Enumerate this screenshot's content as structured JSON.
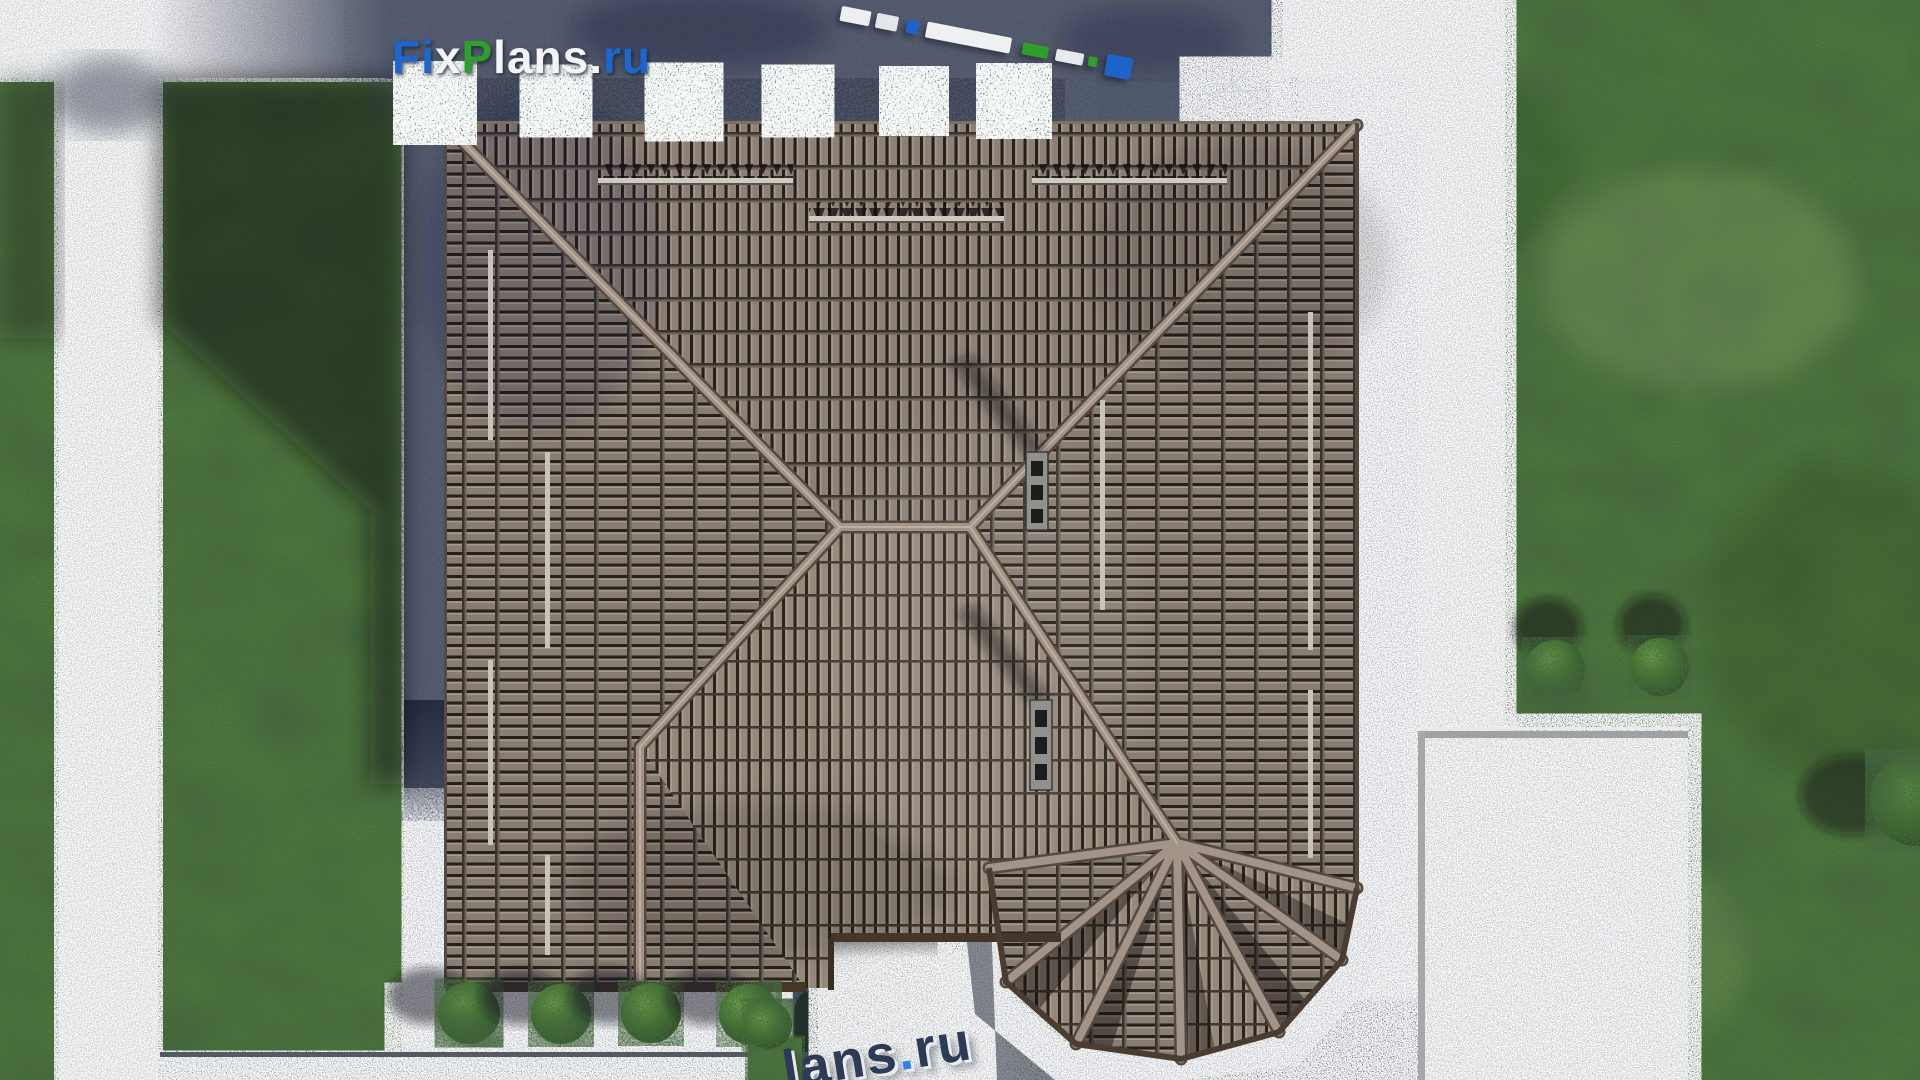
{
  "brand": {
    "logo": {
      "full_text": "FixPlans.ru",
      "parts": [
        {
          "text": "Fi",
          "color": "#1c66d2"
        },
        {
          "text": "x",
          "color": "#f2f4f6"
        },
        {
          "text": "P",
          "color": "#2da02b"
        },
        {
          "text": "lans",
          "color": "#f2f4f6"
        },
        {
          "text": ".",
          "color": "#f2f4f6"
        },
        {
          "text": "ru",
          "color": "#1c66d2"
        }
      ]
    },
    "watermark": {
      "full_text": "lans.ru",
      "parts": [
        {
          "text": "lans",
          "color": "#2e3b58"
        },
        {
          "text": ".",
          "color": "#2f80e8"
        },
        {
          "text": "ru",
          "color": "#2e3b58"
        }
      ]
    }
  },
  "sign3d": {
    "blocks": [
      {
        "w": "30px",
        "h": "15px",
        "color": "#eceef0",
        "gap": "6px"
      },
      {
        "w": "22px",
        "h": "15px",
        "color": "#e4e7ea",
        "gap": "9px"
      },
      {
        "w": "12px",
        "h": "13px",
        "color": "#1e63c8",
        "gap": "8px"
      },
      {
        "w": "86px",
        "h": "16px",
        "color": "#eef0f2",
        "gap": "12px"
      },
      {
        "w": "26px",
        "h": "12px",
        "color": "#2f9e2a",
        "gap": "8px"
      },
      {
        "w": "28px",
        "h": "12px",
        "color": "#e8eaec",
        "gap": "5px"
      },
      {
        "w": "9px",
        "h": "10px",
        "color": "#2f9e2a",
        "gap": "9px"
      },
      {
        "w": "26px",
        "h": "22px",
        "color": "#1e63c8",
        "gap": "0px"
      }
    ]
  },
  "palette": {
    "roof_tile": "#8a7f75",
    "roof_tile_dark": "#27211c",
    "ridge": "#a3948a",
    "fascia": "#46362a",
    "grass_lit": "#4e7838",
    "grass_shadow": "#2b4726",
    "paving_shadow": "#4f5769",
    "gravel": "#b7bcc2",
    "concrete_path": "#d9dcde",
    "platform": "#c8cacc",
    "porch_slab": "#b5b7b9",
    "bush": "#3f7028",
    "accent_blue": "#1c66d2",
    "accent_green": "#2da02b"
  }
}
